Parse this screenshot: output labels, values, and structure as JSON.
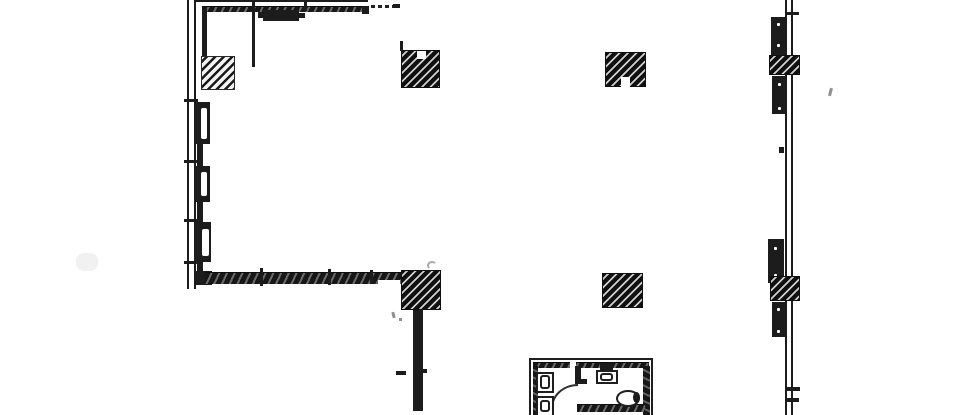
{
  "meta": {
    "colors": {
      "paper": "#ffffff",
      "ink": "#1c1c1c",
      "faint": "#8f8f8f"
    }
  },
  "plan": {
    "elements": [
      {
        "name": "smudge-left",
        "cls": "smudge",
        "x": 76,
        "y": 253,
        "w": 22,
        "h": 18
      },
      {
        "name": "left-wall-outer",
        "cls": "dline-v",
        "x": 187,
        "y": 0,
        "w": 9,
        "h": 289
      },
      {
        "name": "left-wall-tick-1",
        "cls": "bar",
        "x": 184,
        "y": 99,
        "w": 14,
        "h": 3
      },
      {
        "name": "left-wall-tick-2",
        "cls": "bar",
        "x": 184,
        "y": 160,
        "w": 14,
        "h": 3
      },
      {
        "name": "left-wall-tick-3",
        "cls": "bar",
        "x": 184,
        "y": 219,
        "w": 14,
        "h": 3
      },
      {
        "name": "left-wall-tick-4",
        "cls": "bar",
        "x": 184,
        "y": 261,
        "w": 14,
        "h": 3
      },
      {
        "name": "top-wall-outer-line",
        "cls": "bar",
        "x": 196,
        "y": 0,
        "w": 172,
        "h": 2
      },
      {
        "name": "top-wall-band",
        "cls": "band-h",
        "x": 202,
        "y": 6,
        "w": 166,
        "h": 6
      },
      {
        "name": "top-wall-end-corner",
        "cls": "bar",
        "x": 362,
        "y": 6,
        "w": 7,
        "h": 8
      },
      {
        "name": "top-wall-dashed-line",
        "cls": "dash-h",
        "x": 371,
        "y": 5,
        "w": 24,
        "h": 3
      },
      {
        "name": "top-wall-dash-end",
        "cls": "bar",
        "x": 393,
        "y": 4,
        "w": 7,
        "h": 4
      },
      {
        "name": "top-wall-tick",
        "cls": "bar",
        "x": 304,
        "y": 0,
        "w": 3,
        "h": 11
      },
      {
        "name": "interior-line-v",
        "cls": "line-v",
        "x": 252,
        "y": 0,
        "w": 3,
        "h": 67
      },
      {
        "name": "door-header",
        "cls": "bar",
        "x": 263,
        "y": 10,
        "w": 36,
        "h": 11
      },
      {
        "name": "door-header-tab-left",
        "cls": "bar",
        "x": 258,
        "y": 12,
        "w": 5,
        "h": 6
      },
      {
        "name": "door-header-tab-right",
        "cls": "bar",
        "x": 299,
        "y": 13,
        "w": 6,
        "h": 5
      },
      {
        "name": "left-inner-top-line",
        "cls": "bar",
        "x": 202,
        "y": 9,
        "w": 5,
        "h": 48
      },
      {
        "name": "left-wall-column",
        "cls": "hatch-light",
        "x": 201,
        "y": 56,
        "w": 34,
        "h": 34
      },
      {
        "name": "window-pier-1",
        "cls": "bar",
        "x": 195,
        "y": 102,
        "w": 15,
        "h": 42
      },
      {
        "name": "window-pier-1-slot",
        "cls": "slot",
        "x": 201,
        "y": 108,
        "w": 6,
        "h": 31
      },
      {
        "name": "window-connector-1",
        "cls": "bar",
        "x": 197,
        "y": 144,
        "w": 6,
        "h": 23
      },
      {
        "name": "window-pier-2",
        "cls": "bar",
        "x": 195,
        "y": 166,
        "w": 15,
        "h": 36
      },
      {
        "name": "window-pier-2-slot",
        "cls": "slot",
        "x": 201,
        "y": 172,
        "w": 6,
        "h": 24
      },
      {
        "name": "window-connector-2",
        "cls": "bar",
        "x": 197,
        "y": 202,
        "w": 6,
        "h": 21
      },
      {
        "name": "window-pier-3",
        "cls": "bar",
        "x": 194,
        "y": 222,
        "w": 17,
        "h": 40
      },
      {
        "name": "window-pier-3-slot",
        "cls": "slot",
        "x": 202,
        "y": 229,
        "w": 7,
        "h": 27
      },
      {
        "name": "window-connector-3",
        "cls": "bar",
        "x": 197,
        "y": 262,
        "w": 6,
        "h": 11
      },
      {
        "name": "corner-bottom-left",
        "cls": "bar",
        "x": 194,
        "y": 271,
        "w": 18,
        "h": 14
      },
      {
        "name": "bottom-wall-band",
        "cls": "band-h",
        "x": 205,
        "y": 272,
        "w": 197,
        "h": 12
      },
      {
        "name": "bottom-wall-thin-gap",
        "cls": "white",
        "x": 378,
        "y": 280,
        "w": 22,
        "h": 5
      },
      {
        "name": "bottom-wall-tick-1",
        "cls": "bar",
        "x": 260,
        "y": 268,
        "w": 3,
        "h": 18
      },
      {
        "name": "bottom-wall-tick-2",
        "cls": "bar",
        "x": 328,
        "y": 269,
        "w": 3,
        "h": 16
      },
      {
        "name": "bottom-wall-tick-3",
        "cls": "bar",
        "x": 370,
        "y": 270,
        "w": 3,
        "h": 14
      },
      {
        "name": "column-top-left",
        "cls": "hatch-dark",
        "x": 401,
        "y": 50,
        "w": 39,
        "h": 38
      },
      {
        "name": "column-top-left-notch",
        "cls": "white",
        "x": 417,
        "y": 51,
        "w": 9,
        "h": 8
      },
      {
        "name": "column-top-left-stub",
        "cls": "bar",
        "x": 400,
        "y": 41,
        "w": 3,
        "h": 10
      },
      {
        "name": "column-top-mid",
        "cls": "hatch-dark",
        "x": 605,
        "y": 52,
        "w": 41,
        "h": 35
      },
      {
        "name": "column-top-mid-notch",
        "cls": "white",
        "x": 621,
        "y": 77,
        "w": 9,
        "h": 10
      },
      {
        "name": "column-bottom-mid",
        "cls": "hatch-dark",
        "x": 602,
        "y": 273,
        "w": 41,
        "h": 35
      },
      {
        "name": "column-bottom-left",
        "cls": "hatch-dark",
        "x": 401,
        "y": 270,
        "w": 40,
        "h": 40
      },
      {
        "name": "curl-mark",
        "cls": "curl",
        "x": 427,
        "y": 261,
        "w": 10,
        "h": 9
      },
      {
        "name": "stray-mark-1",
        "cls": "mark",
        "x": 392,
        "y": 312,
        "w": 3,
        "h": 6,
        "rot": -15
      },
      {
        "name": "stray-mark-2",
        "cls": "mark",
        "x": 399,
        "y": 318,
        "w": 3,
        "h": 3
      },
      {
        "name": "lower-wall",
        "cls": "bar",
        "x": 413,
        "y": 310,
        "w": 10,
        "h": 101
      },
      {
        "name": "lower-wall-tick",
        "cls": "bar",
        "x": 396,
        "y": 371,
        "w": 10,
        "h": 4
      },
      {
        "name": "lower-wall-nub",
        "cls": "bar",
        "x": 423,
        "y": 369,
        "w": 4,
        "h": 4
      },
      {
        "name": "right-wall",
        "cls": "dline-v",
        "x": 785,
        "y": 0,
        "w": 8,
        "h": 415
      },
      {
        "name": "right-wall-top-tick",
        "cls": "bar",
        "x": 785,
        "y": 12,
        "w": 14,
        "h": 3
      },
      {
        "name": "right-pier-1",
        "cls": "bar",
        "x": 771,
        "y": 17,
        "w": 15,
        "h": 38
      },
      {
        "name": "right-pier-1-dot-a",
        "cls": "dot",
        "x": 777,
        "y": 23,
        "w": 3,
        "h": 3
      },
      {
        "name": "right-pier-1-dot-b",
        "cls": "dot",
        "x": 777,
        "y": 44,
        "w": 3,
        "h": 3
      },
      {
        "name": "right-column-1",
        "cls": "hatch-dark",
        "x": 769,
        "y": 55,
        "w": 31,
        "h": 20
      },
      {
        "name": "right-pier-2",
        "cls": "bar",
        "x": 772,
        "y": 76,
        "w": 15,
        "h": 38
      },
      {
        "name": "right-pier-2-dot-a",
        "cls": "dot",
        "x": 778,
        "y": 83,
        "w": 3,
        "h": 3
      },
      {
        "name": "right-pier-2-dot-b",
        "cls": "dot",
        "x": 778,
        "y": 107,
        "w": 3,
        "h": 3
      },
      {
        "name": "right-wall-mid-tick",
        "cls": "bar",
        "x": 779,
        "y": 147,
        "w": 5,
        "h": 6
      },
      {
        "name": "right-pier-3",
        "cls": "bar",
        "x": 768,
        "y": 239,
        "w": 16,
        "h": 44
      },
      {
        "name": "right-pier-3-dot-a",
        "cls": "dot",
        "x": 774,
        "y": 247,
        "w": 3,
        "h": 3
      },
      {
        "name": "right-pier-3-dot-b",
        "cls": "dot",
        "x": 774,
        "y": 274,
        "w": 3,
        "h": 3
      },
      {
        "name": "right-column-2",
        "cls": "hatch-dark",
        "x": 770,
        "y": 276,
        "w": 30,
        "h": 25
      },
      {
        "name": "right-pier-4",
        "cls": "bar",
        "x": 772,
        "y": 302,
        "w": 15,
        "h": 35
      },
      {
        "name": "right-pier-4-dot-a",
        "cls": "dot",
        "x": 777,
        "y": 308,
        "w": 3,
        "h": 3
      },
      {
        "name": "right-pier-4-dot-b",
        "cls": "dot",
        "x": 777,
        "y": 330,
        "w": 3,
        "h": 3
      },
      {
        "name": "right-wall-stub-1",
        "cls": "bar",
        "x": 787,
        "y": 387,
        "w": 13,
        "h": 4
      },
      {
        "name": "right-wall-stub-2",
        "cls": "bar",
        "x": 787,
        "y": 398,
        "w": 12,
        "h": 4
      },
      {
        "name": "apostrophe-mark",
        "cls": "mark",
        "x": 829,
        "y": 88,
        "w": 3,
        "h": 8,
        "rot": 15
      },
      {
        "name": "restroom-outline",
        "cls": "outline-open-bottom",
        "x": 529,
        "y": 358,
        "w": 124,
        "h": 57
      },
      {
        "name": "restroom-band-top",
        "cls": "band-h",
        "x": 533,
        "y": 362,
        "w": 116,
        "h": 6
      },
      {
        "name": "restroom-band-left",
        "cls": "band-v",
        "x": 533,
        "y": 366,
        "w": 5,
        "h": 49
      },
      {
        "name": "restroom-band-right",
        "cls": "band-v",
        "x": 643,
        "y": 366,
        "w": 7,
        "h": 49
      },
      {
        "name": "restroom-wall-gap",
        "cls": "white",
        "x": 570,
        "y": 360,
        "w": 6,
        "h": 9
      },
      {
        "name": "restroom-vent-block",
        "cls": "bar",
        "x": 600,
        "y": 363,
        "w": 13,
        "h": 8
      },
      {
        "name": "sink-counter",
        "cls": "outline",
        "x": 596,
        "y": 370,
        "w": 22,
        "h": 14
      },
      {
        "name": "sink-basin",
        "cls": "inner-rounded",
        "x": 600,
        "y": 373,
        "w": 13,
        "h": 8
      },
      {
        "name": "stall-partition-v",
        "cls": "bar",
        "x": 575,
        "y": 366,
        "w": 6,
        "h": 16
      },
      {
        "name": "stall-partition-h",
        "cls": "bar",
        "x": 575,
        "y": 379,
        "w": 12,
        "h": 5
      },
      {
        "name": "door-swing-arc",
        "cls": "arc",
        "x": 551,
        "y": 384,
        "w": 27,
        "h": 24
      },
      {
        "name": "stall-wall-band",
        "cls": "band-h",
        "x": 577,
        "y": 404,
        "w": 68,
        "h": 8
      },
      {
        "name": "toilet-bowl",
        "cls": "oval",
        "x": 616,
        "y": 390,
        "w": 24,
        "h": 17
      },
      {
        "name": "toilet-tank-mark",
        "cls": "bar",
        "x": 633,
        "y": 392,
        "w": 7,
        "h": 11,
        "r": "50%"
      },
      {
        "name": "fixture-1-outer",
        "cls": "outline",
        "x": 536,
        "y": 372,
        "w": 18,
        "h": 21
      },
      {
        "name": "fixture-1-inner",
        "cls": "inner-rounded",
        "x": 540,
        "y": 375,
        "w": 10,
        "h": 14
      },
      {
        "name": "fixture-2-outer",
        "cls": "outline-open-bottom",
        "x": 536,
        "y": 396,
        "w": 18,
        "h": 19
      },
      {
        "name": "fixture-2-inner",
        "cls": "inner-rounded",
        "x": 540,
        "y": 400,
        "w": 10,
        "h": 12
      }
    ]
  }
}
